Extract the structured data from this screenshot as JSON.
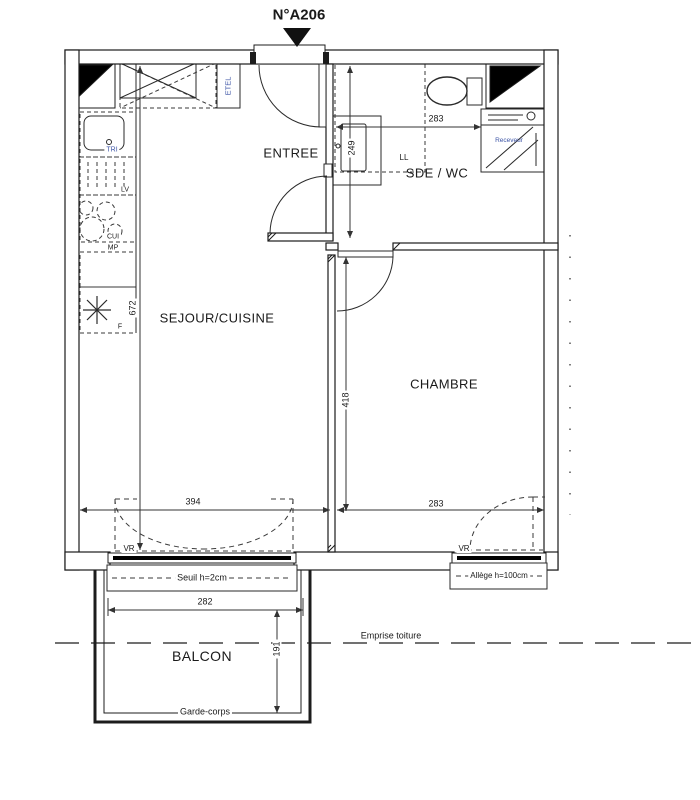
{
  "meta": {
    "unit_label": "N°A206"
  },
  "rooms": {
    "entree": "ENTREE",
    "sde_wc": "SDE / WC",
    "sejour_cuisine": "SEJOUR/CUISINE",
    "chambre": "CHAMBRE",
    "balcon": "BALCON"
  },
  "dimensions_cm": {
    "sde_wc_width": "283",
    "sde_wc_depth": "249",
    "sejour_height": "672",
    "chambre_height": "418",
    "chambre_width": "283",
    "sejour_window_width": "394",
    "balcon_width": "282",
    "balcon_depth": "191"
  },
  "annotations": {
    "etel": "ETEL",
    "lave_linge": "LL",
    "tri": "TRI",
    "lave_vaisselle": "LV",
    "cuisson": "CUI",
    "meuble_plan": "MP",
    "frigo": "F",
    "receveur": "Receveur",
    "volet_roulant_sejour": "VR",
    "volet_roulant_chambre": "VR",
    "seuil": "Seuil h=2cm",
    "allege": "Allège h=100cm",
    "garde_corps": "Garde-corps",
    "emprise_toiture": "Emprise toiture"
  },
  "colors": {
    "line": "#1c1c1c",
    "annotation_blue": "#3d55a6"
  }
}
